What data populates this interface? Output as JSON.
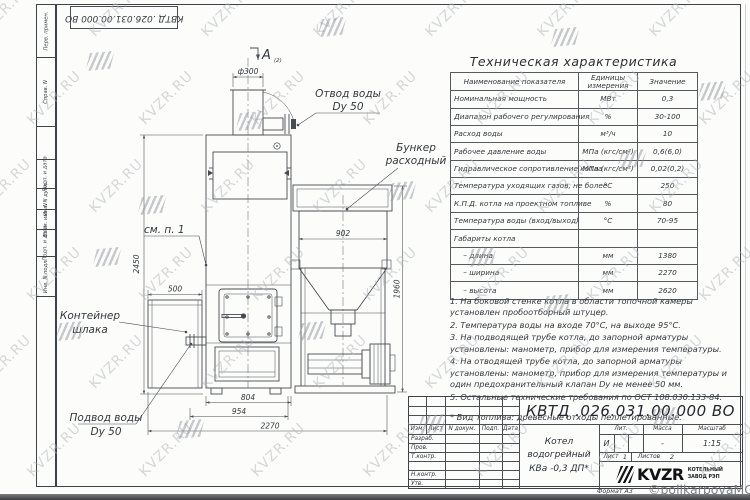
{
  "watermark": {
    "text": "KVZR.RU",
    "credit": "©polikarpovaMG2021"
  },
  "frame": {
    "stamp_number": "КВТД .026.031.00.000 ВО",
    "format_label": "Формат А3",
    "left_labels_segments": [
      "Перв. примен.",
      "Справ. N",
      "",
      "Подп. и дата",
      "Инв. N дубл.",
      "Взам. инв. N",
      "Подп. и дата",
      "Инв. N подл.",
      ""
    ]
  },
  "spec_table": {
    "title": "Техническая характеристика",
    "headers": [
      "Наименование показателя",
      "Единицы измерения",
      "Значение"
    ],
    "rows": [
      [
        "Номинальная мощность",
        "МВт",
        "0,3"
      ],
      [
        "Диапазон рабочего регулирования",
        "%",
        "30-100"
      ],
      [
        "Расход воды",
        "м³/ч",
        "10"
      ],
      [
        "Рабочее давление воды",
        "МПа (кгс/см²)",
        "0,6(6,0)"
      ],
      [
        "Гидравлическое сопротивление котла",
        "МПа (кгс/см²)",
        "0,02(0,2)"
      ],
      [
        "Температура уходящих газов, не более",
        "°С",
        "250"
      ],
      [
        "К.П.Д. котла на проектном топливе",
        "%",
        "80"
      ],
      [
        "Температура воды (вход/выход)",
        "°С",
        "70-95"
      ],
      [
        "Габариты котла",
        "",
        ""
      ],
      [
        "    – длина",
        "мм",
        "1380"
      ],
      [
        "    – ширина",
        "мм",
        "2270"
      ],
      [
        "    – высота",
        "мм",
        "2620"
      ]
    ]
  },
  "notes": [
    "1.  На боковой стенке котла в области топочной камеры установлен пробоотборный штуцер.",
    "2.  Температура воды на входе 70°С, на выходе 95°С.",
    "3.  На подводящей трубе котла, до запорной арматуры установлены: манометр, прибор для измерения температуры.",
    "4.  На отводящей трубе котла, до запорной арматуры установлены: манометр, прибор для измерения температуры и один предохранительный клапан Dy не менее 50 мм.",
    "5.  Остальные технические требования по ОСТ 108.030.133-84."
  ],
  "fuel_note": "*  Вид топлива: древесные отходы пеллетированные.",
  "drawing": {
    "view_arrow_label": "А",
    "view_arrow_ref": "(2)",
    "dim_d300": "ф300",
    "dim_902": "902",
    "dim_500": "500",
    "dim_2450": "2450",
    "dim_1960": "1960",
    "dim_804": "804",
    "dim_954": "954",
    "dim_2270": "2270",
    "label_outlet_1": "Отвод воды",
    "label_outlet_2": "Dy 50",
    "label_bunker_1": "Бункер",
    "label_bunker_2": "расходный",
    "label_see_note": "см. п. 1",
    "label_slag_1": "Контейнер",
    "label_slag_2": "шлака",
    "label_inlet_1": "Подвод воды",
    "label_inlet_2": "Dy 50"
  },
  "title_block": {
    "doc_number": "КВТД .026.031.00.000  ВО",
    "product_name_line1": "Котел водогрейный",
    "product_name_line2": "КВа -0,3  ДП*",
    "col_izm": "Изм.",
    "col_list": "Лист",
    "col_doc": "N докум.",
    "col_podp": "Подп.",
    "col_data": "Дата",
    "row_razrab": "Разраб.",
    "row_prov": "Пров.",
    "row_tkontr": "Т.контр.",
    "row_nkontr": "Н.контр.",
    "row_utv": "Утв.",
    "lit_label": "Лит.",
    "mass_label": "Масса",
    "scale_label": "Масштаб",
    "lit_value": "И",
    "mass_value": "-",
    "scale_value": "1:15",
    "sheet_label": "Лист",
    "sheet_value": "1",
    "sheets_label": "Листов",
    "sheets_value": "2",
    "company_name": "KVZR",
    "company_sub1": "КОТЕЛЬНЫЙ",
    "company_sub2": "ЗАВОД РЭП"
  }
}
